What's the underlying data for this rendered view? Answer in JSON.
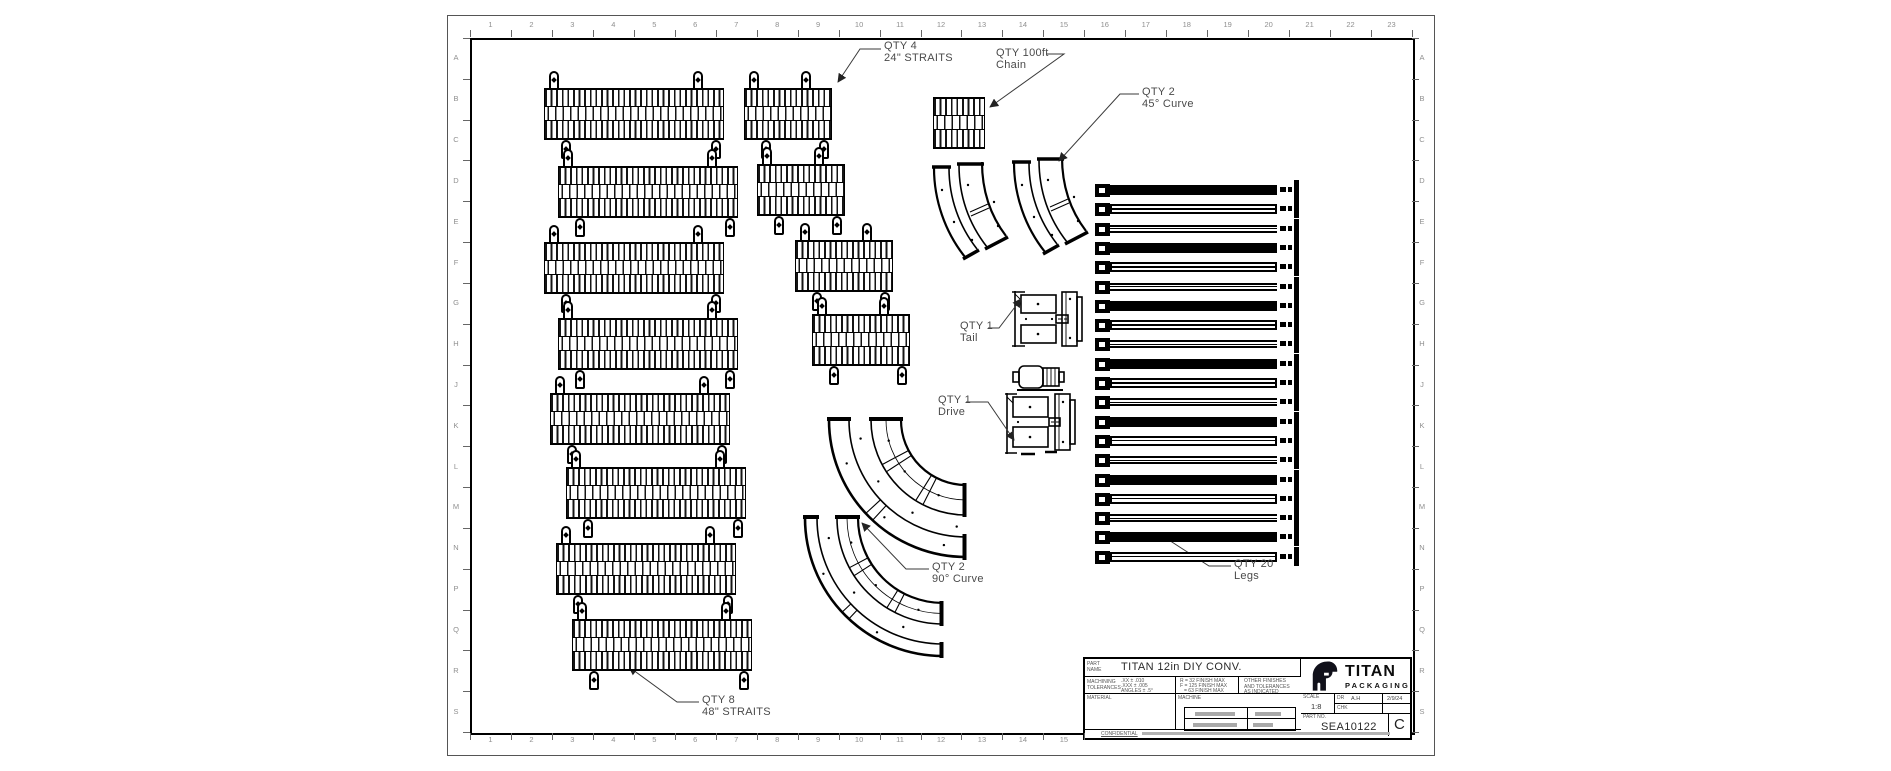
{
  "drawing": {
    "colors": {
      "line": "#000000",
      "label_text": "#4a4a4a",
      "ruler_text": "#8f8f8f"
    },
    "ruler": {
      "columns": [
        "1",
        "2",
        "3",
        "4",
        "5",
        "6",
        "7",
        "8",
        "9",
        "10",
        "11",
        "12",
        "13",
        "14",
        "15",
        "16",
        "17",
        "18",
        "19",
        "20",
        "21",
        "22",
        "23"
      ],
      "rows": [
        "A",
        "B",
        "C",
        "D",
        "E",
        "F",
        "G",
        "H",
        "J",
        "K",
        "L",
        "M",
        "N",
        "P",
        "Q",
        "R",
        "S"
      ]
    },
    "annotations": [
      {
        "line1": "QTY 4",
        "line2": "24\" STRAITS"
      },
      {
        "line1": "QTY 100ft",
        "line2": "Chain"
      },
      {
        "line1": "QTY 2",
        "line2": "45° Curve"
      },
      {
        "line1": "QTY 1",
        "line2": "Tail"
      },
      {
        "line1": "QTY 1",
        "line2": "Drive"
      },
      {
        "line1": "QTY 2",
        "line2": "90° Curve"
      },
      {
        "line1": "QTY 8",
        "line2": "48\" STRAITS"
      },
      {
        "line1": "QTY 20",
        "line2": "Legs"
      }
    ],
    "title_block": {
      "part_name_label": "PART NAME",
      "part_name": "TITAN 12in DIY CONV.",
      "machining_label": "MACHINING TOLERANCES",
      "tolerances": [
        ".XX ± .010",
        ".XXX ± .005",
        "ANGLES ± .5°"
      ],
      "finish_notes": [
        "R = 32 FINISH MAX",
        "F = 125 FINISH MAX",
        "= 63 FINISH MAX"
      ],
      "other_note": "OTHER FINISHES AND TOLERANCES AS INDICATED",
      "material_label": "MATERIAL",
      "machine_label": "MACHINE",
      "brand_name": "TITAN",
      "brand_sub": "PACKAGING",
      "scale_label": "SCALE",
      "scale_value": "1:8",
      "drawn_label": "DR",
      "drawn_value": "A.H",
      "date_value": "2/9/24",
      "check_label": "CHK",
      "part_no_label": "PART NO.",
      "part_no": "SEA10122",
      "revision": "C",
      "confidential": "CONFIDENTIAL"
    }
  }
}
